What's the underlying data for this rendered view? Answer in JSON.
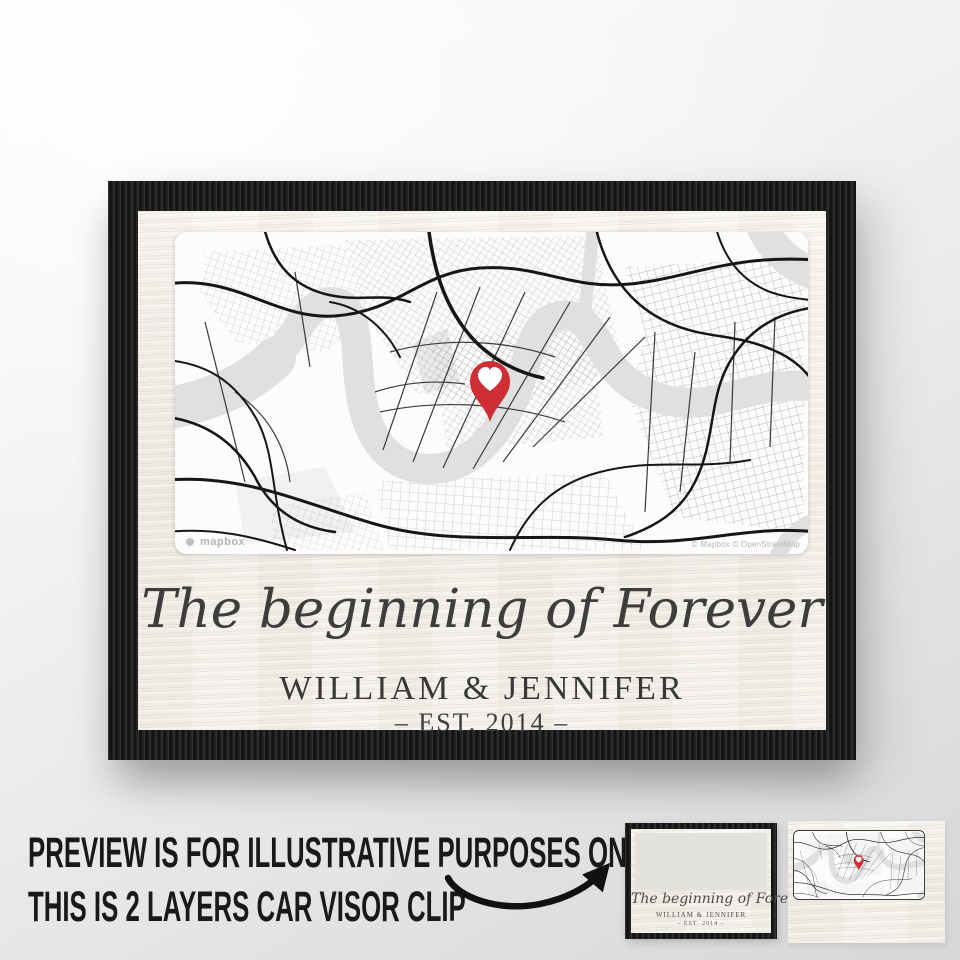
{
  "poster": {
    "title": "The beginning of Forever",
    "names": "WILLIAM & JENNIFER",
    "established": "– EST. 2014 –"
  },
  "map": {
    "watermark": "mapbox",
    "attribution": "© Mapbox © OpenStreetMap"
  },
  "caption": {
    "line1": "PREVIEW IS FOR ILLUSTRATIVE PURPOSES ONLY",
    "line2": "THIS IS 2 LAYERS CAR VISOR CLIP"
  },
  "thumbnails": {
    "layer1": {
      "title": "The beginning of Forever",
      "names": "WILLIAM & JENNIFER",
      "established": "– EST. 2014 –"
    }
  },
  "icons": {
    "pin": "heart-map-pin-icon",
    "arrow": "curved-arrow-icon",
    "mapbox_logo": "mapbox-logo-icon"
  },
  "colors": {
    "pin_red": "#cf2e34",
    "frame_black": "#1b1b1b",
    "text_dark": "#3d3d3d",
    "river_gray": "#e0e0e0"
  }
}
